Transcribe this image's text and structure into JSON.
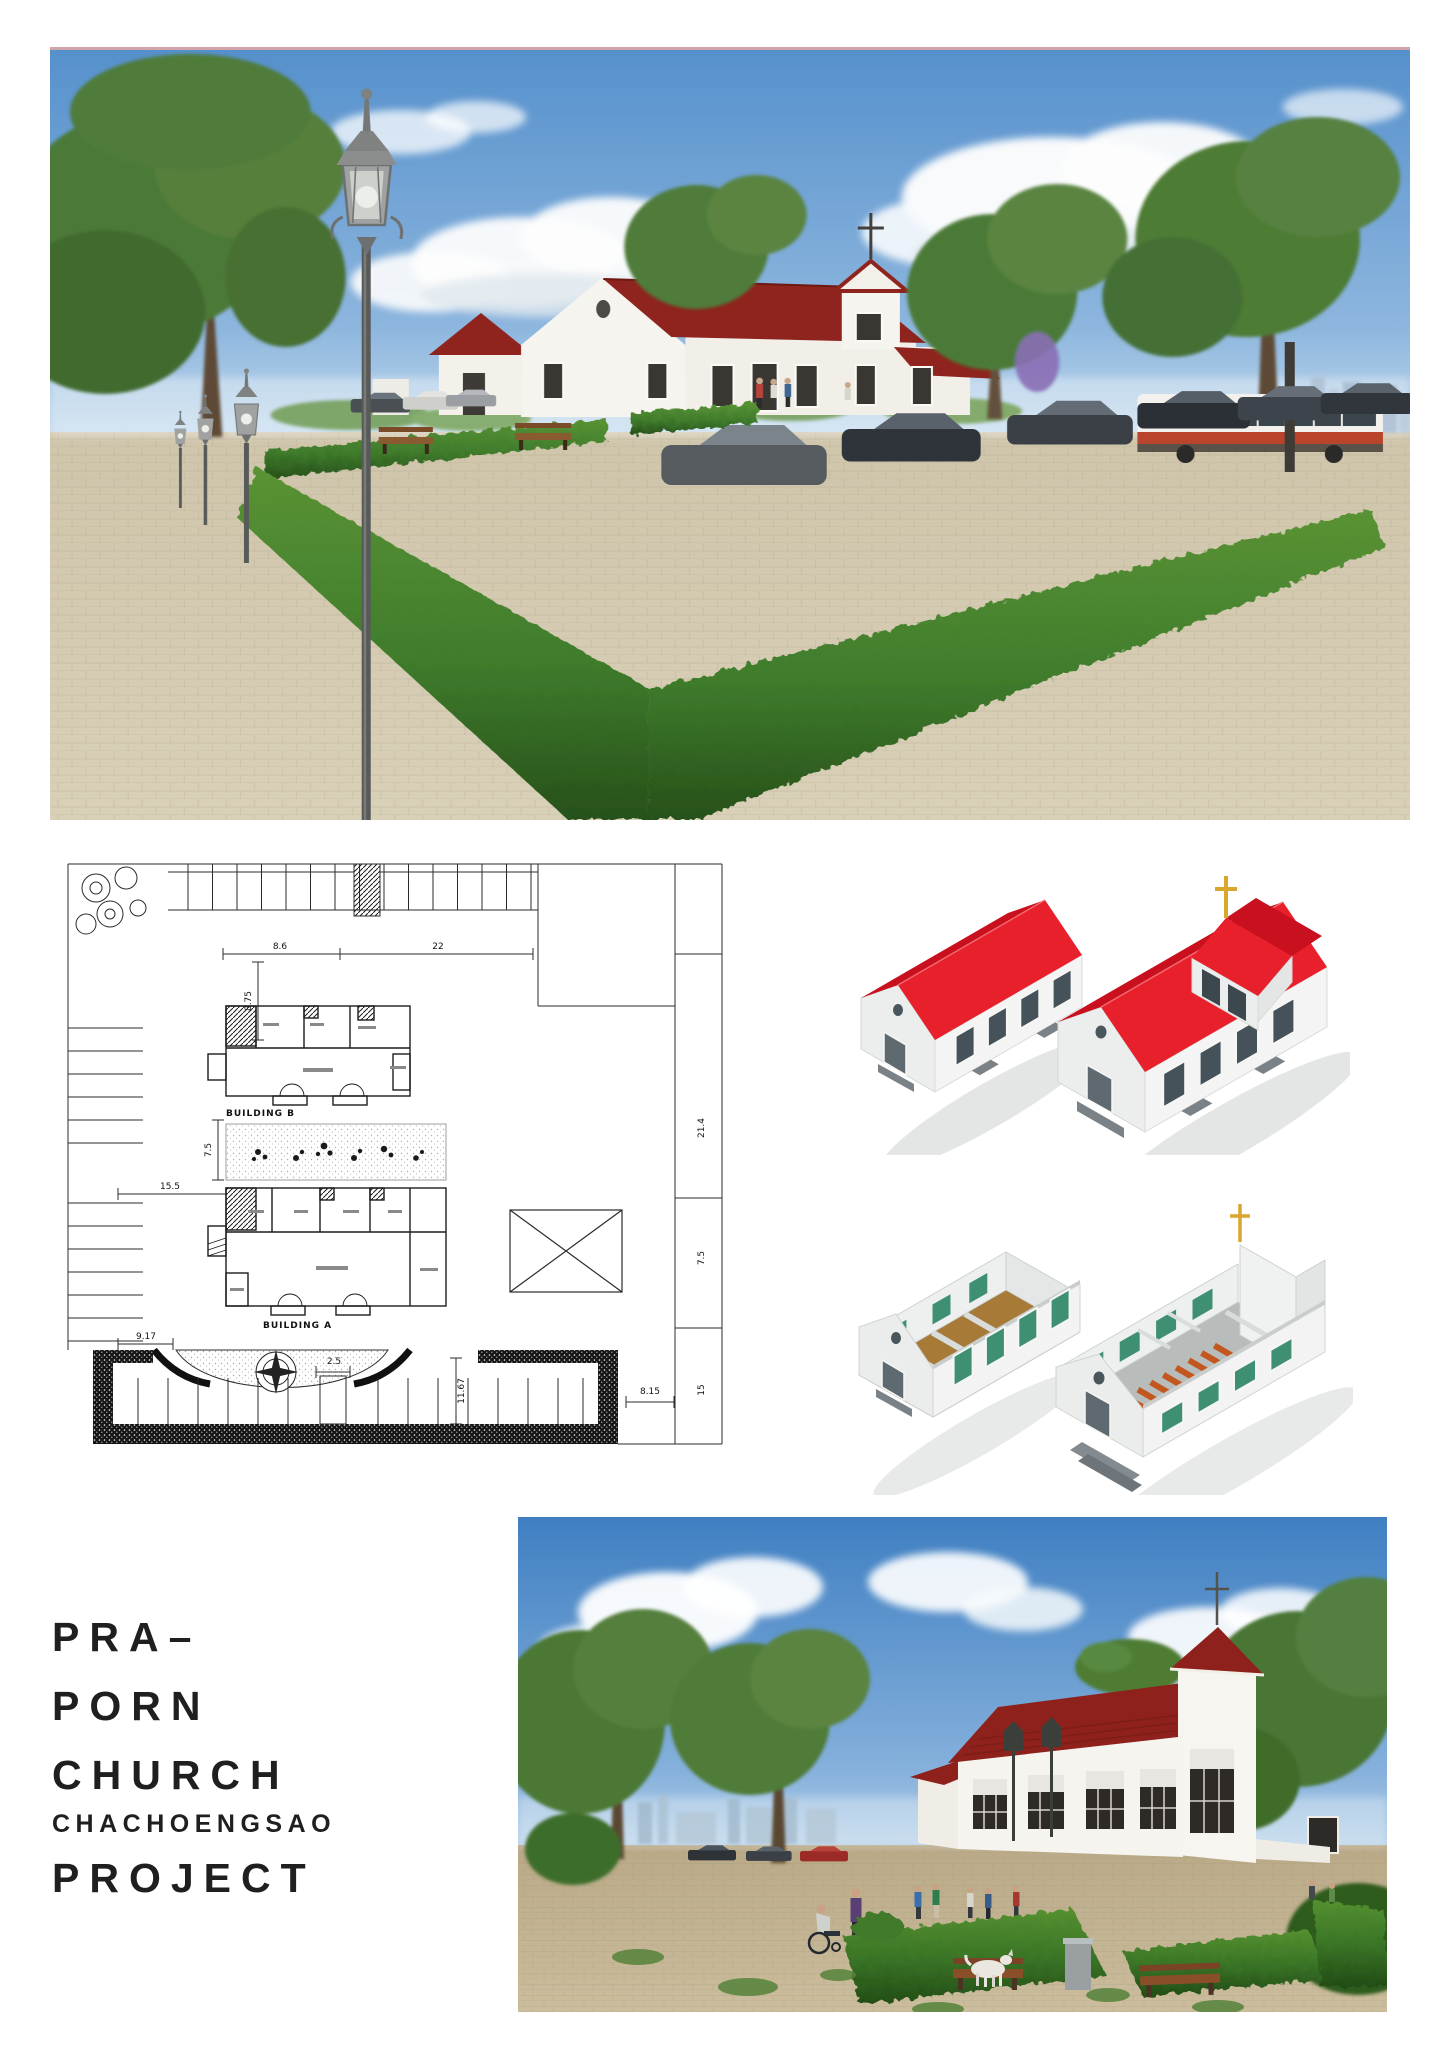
{
  "page": {
    "background": "#ffffff"
  },
  "title_block": {
    "lines": [
      "PRA–",
      "PORN",
      "CHURCH",
      "CHACHOENGSAO",
      "PROJECT"
    ],
    "text_color": "#1f1f1f"
  },
  "site_plan": {
    "building_a_label": "BUILDING A",
    "building_b_label": "BUILDING B",
    "dimensions": {
      "top_left": "8.6",
      "top_right": "22",
      "upper_vertical": "8.75",
      "garden_vertical": "7.5",
      "west_drive": "15.5",
      "plaza_gap": "9.17",
      "gate_width": "2.5",
      "plaza_depth": "11.67",
      "east_gate": "8.15",
      "road_upper": "21.4",
      "road_mid": "7.5",
      "road_lower": "15"
    }
  },
  "palette": {
    "sky_blue": "#5590cc",
    "render_roof_red": "#8e241d",
    "axon_roof_red": "#e8202b",
    "hedge_green": "#3f7c2c",
    "ground_tan": "#c9bfa3",
    "cross_gold": "#d9a62e",
    "plan_line": "#2b2b2b"
  }
}
